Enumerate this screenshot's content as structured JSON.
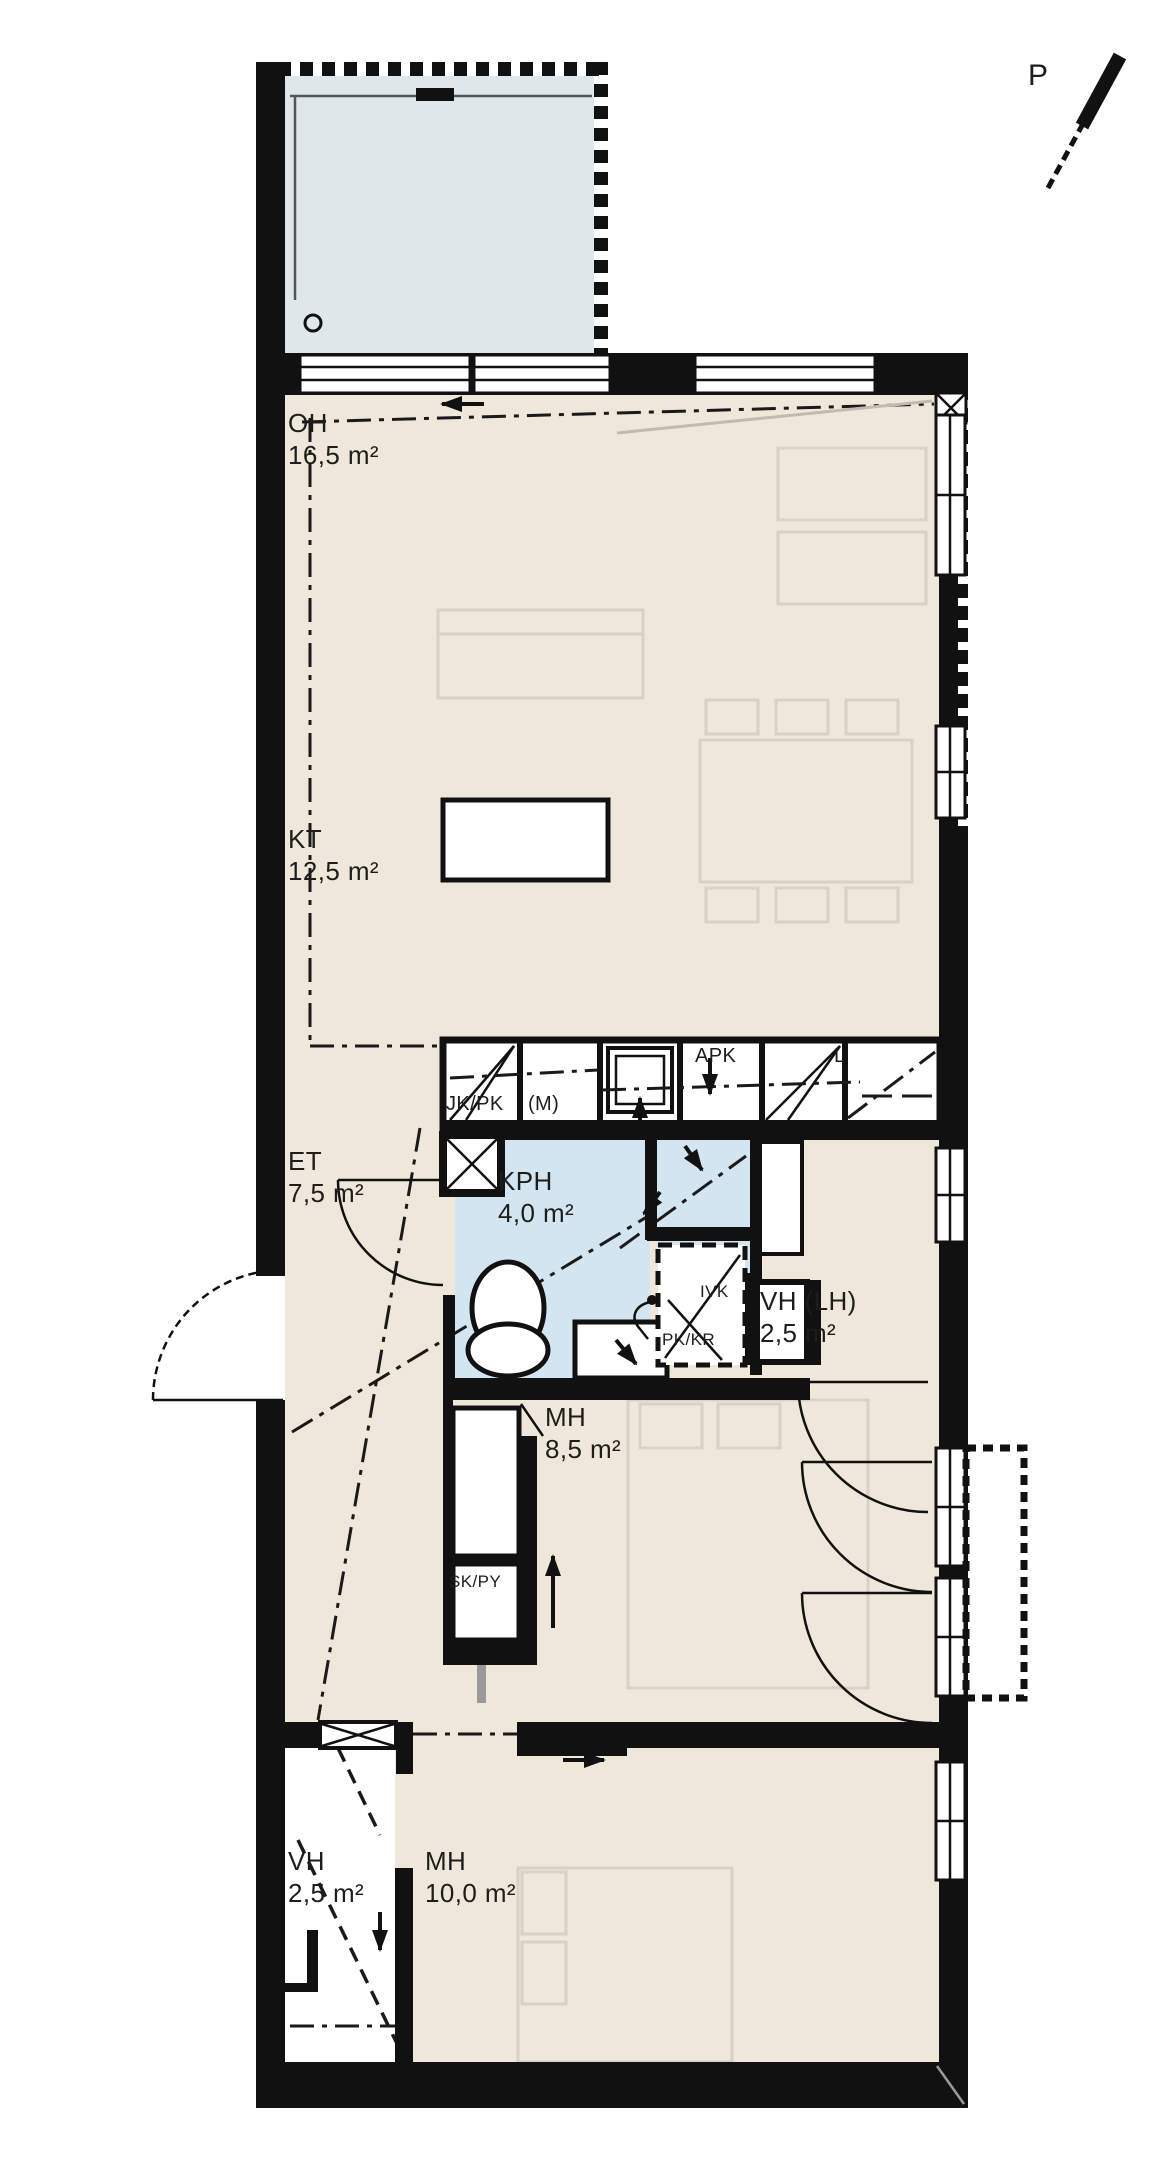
{
  "plan_title": "apartment-floor-plan",
  "rooms": {
    "oh": {
      "name": "OH",
      "area": "16,5 m²"
    },
    "kt": {
      "name": "KT",
      "area": "12,5 m²"
    },
    "et": {
      "name": "ET",
      "area": "7,5 m²"
    },
    "kph": {
      "name": "KPH",
      "area": "4,0 m²"
    },
    "vh_lh": {
      "name": "VH (LH)",
      "area": "2,5 m²"
    },
    "mh_small": {
      "name": "MH",
      "area": "8,5 m²"
    },
    "vh_entry": {
      "name": "VH",
      "area": "2,5 m²"
    },
    "mh_large": {
      "name": "MH",
      "area": "10,0 m²"
    }
  },
  "kitchen": {
    "fridge_freezer": "JK/PK",
    "microwave_slot": "(M)",
    "dishwasher": "APK",
    "stove": "L"
  },
  "utility": {
    "cleaning_laundry_closet": "SK/PY",
    "ventilation_unit": "IVK",
    "washer_dryer_slot": "PK/KR"
  },
  "compass": {
    "north": "P"
  },
  "colors": {
    "wall": "#111111",
    "room_fill": "#efe8da",
    "bathroom_fill": "#d3e5f1",
    "balcony_fill": "#dee7ea",
    "furniture_line": "#d8d2c4",
    "text": "#1d1d1b"
  }
}
